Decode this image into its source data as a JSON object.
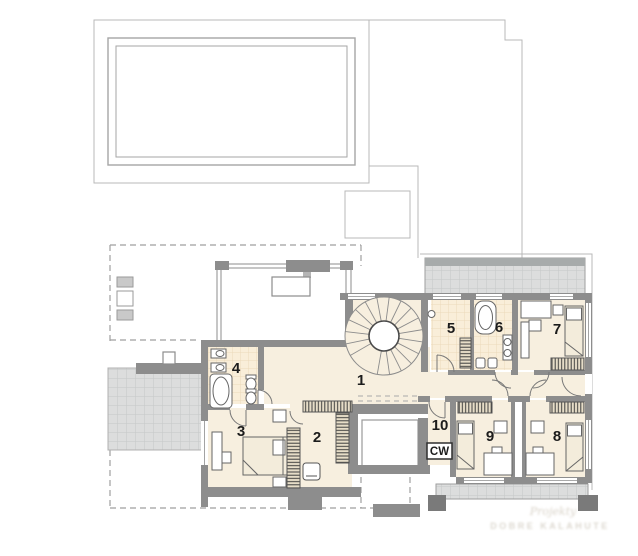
{
  "plan": {
    "rooms": [
      {
        "number": "1"
      },
      {
        "number": "2"
      },
      {
        "number": "3"
      },
      {
        "number": "4"
      },
      {
        "number": "5"
      },
      {
        "number": "6"
      },
      {
        "number": "7"
      },
      {
        "number": "8"
      },
      {
        "number": "9"
      },
      {
        "number": "10"
      }
    ],
    "labels": {
      "cw": "CW"
    },
    "watermark": {
      "line1": "Projekty",
      "line2": "DOBRE KALAHUTE"
    },
    "colors": {
      "wall": "#8d8d8d",
      "floor": "#f7efdf",
      "bath_tile": "#f9eed9",
      "terrace": "#dcdddd",
      "outline": "#b9b9b9",
      "hatch": "#3e3e3e"
    }
  }
}
